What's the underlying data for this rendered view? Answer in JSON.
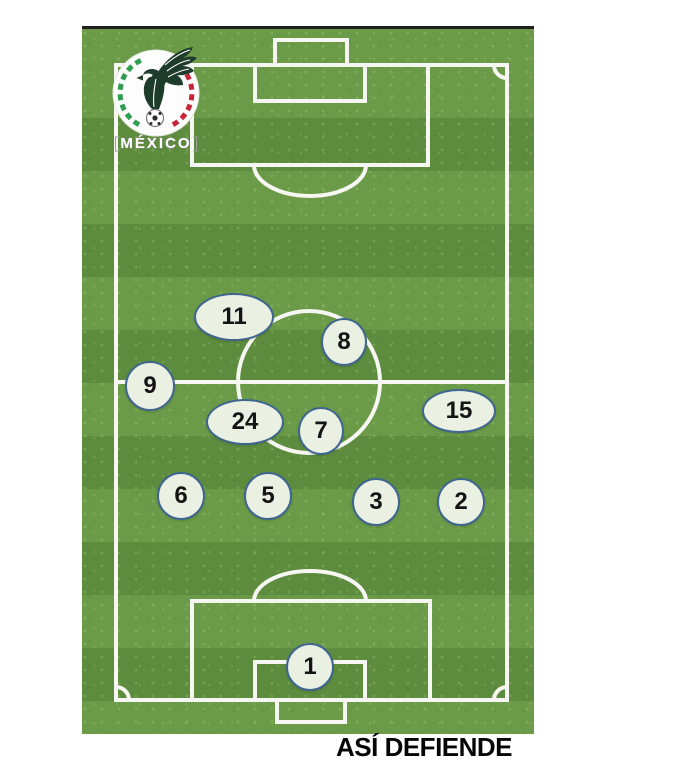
{
  "caption": "ASÍ DEFIENDE",
  "badge": {
    "team": "MÉXICO",
    "crest_green": "#2f9e50",
    "crest_red": "#c9253a",
    "eagle_color": "#1e3c2b"
  },
  "pitch": {
    "stripe_light": "#6b9b48",
    "stripe_dark": "#5d8c3e",
    "line_color": "#f6f6f2",
    "top_border_color": "#1f1f1f"
  },
  "marker_style": {
    "fill": "#eaf0e2",
    "border": "#3f6690",
    "text_color": "#141414"
  },
  "formation": {
    "players": [
      {
        "number": "11",
        "cx": 150,
        "cy": 286,
        "rx": 38,
        "ry": 22
      },
      {
        "number": "8",
        "cx": 260,
        "cy": 311,
        "rx": 21,
        "ry": 22
      },
      {
        "number": "9",
        "cx": 66,
        "cy": 355,
        "rx": 23,
        "ry": 23
      },
      {
        "number": "24",
        "cx": 161,
        "cy": 391,
        "rx": 37,
        "ry": 21
      },
      {
        "number": "7",
        "cx": 237,
        "cy": 400,
        "rx": 21,
        "ry": 22
      },
      {
        "number": "15",
        "cx": 375,
        "cy": 380,
        "rx": 35,
        "ry": 20
      },
      {
        "number": "6",
        "cx": 97,
        "cy": 465,
        "rx": 22,
        "ry": 22
      },
      {
        "number": "5",
        "cx": 184,
        "cy": 465,
        "rx": 22,
        "ry": 22
      },
      {
        "number": "3",
        "cx": 292,
        "cy": 471,
        "rx": 22,
        "ry": 22
      },
      {
        "number": "2",
        "cx": 377,
        "cy": 471,
        "rx": 22,
        "ry": 22
      },
      {
        "number": "1",
        "cx": 226,
        "cy": 636,
        "rx": 22,
        "ry": 22
      }
    ]
  }
}
